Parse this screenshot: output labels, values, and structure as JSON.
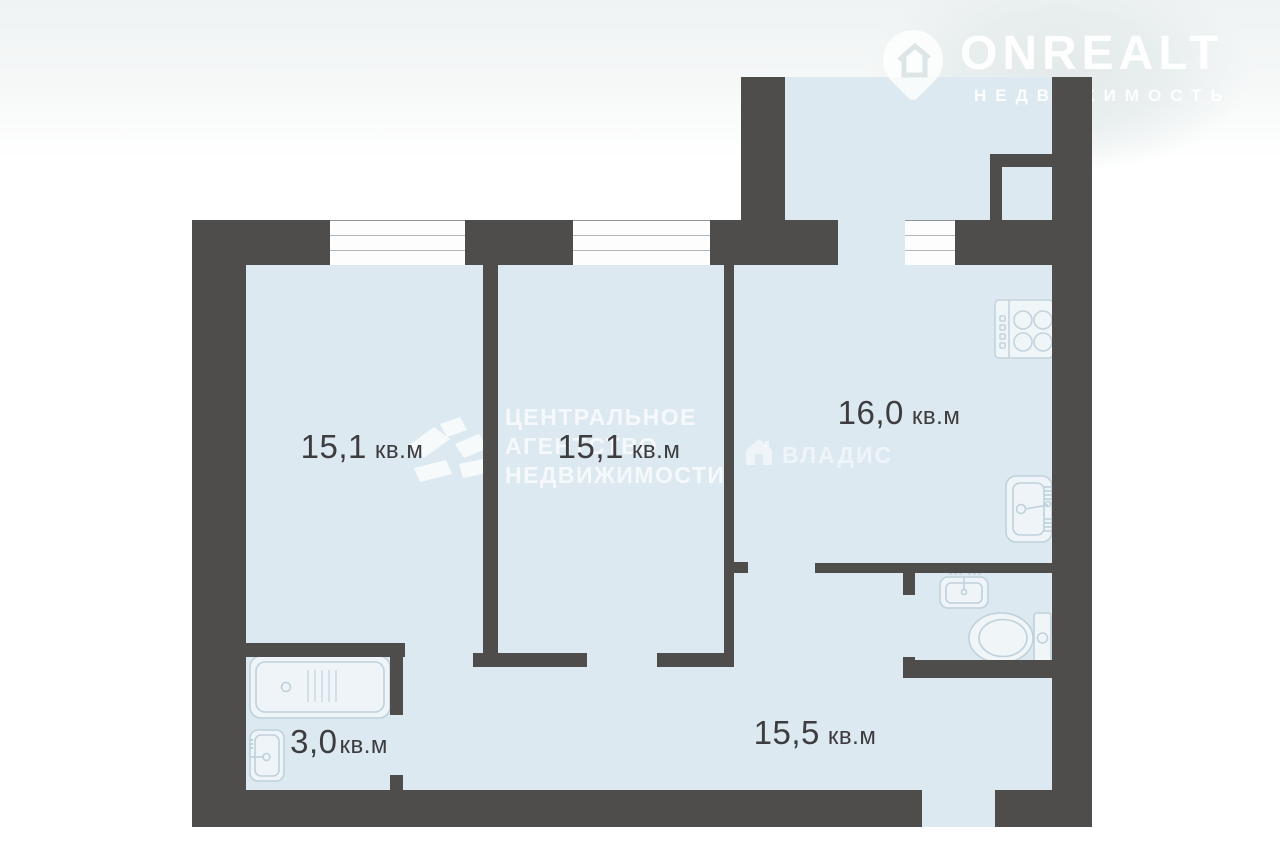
{
  "branding": {
    "logo": {
      "name": "ONREALT",
      "subtitle": "НЕДВИЖИМОСТЬ"
    },
    "watermark_agency": {
      "lines": [
        "ЦЕНТРАЛЬНОЕ",
        "АГЕНТСТВО",
        "НЕДВИЖИМОСТИ"
      ]
    },
    "watermark_vladis": {
      "name": "ВЛАДИС"
    }
  },
  "floorplan": {
    "type": "apartment-floor-plan",
    "rooms": [
      {
        "id": "room-left",
        "area": "15,1",
        "unit": "кв.м"
      },
      {
        "id": "room-middle",
        "area": "15,1",
        "unit": "кв.м"
      },
      {
        "id": "kitchen",
        "area": "16,0",
        "unit": "кв.м"
      },
      {
        "id": "bathroom",
        "area": "3,0",
        "unit": "кв.м"
      },
      {
        "id": "hallway",
        "area": "15,5",
        "unit": "кв.м"
      }
    ],
    "fixtures": [
      "stove",
      "kitchen-sink",
      "wc-sink",
      "toilet",
      "bathtub",
      "bathroom-sink"
    ],
    "colors": {
      "wall": "#4f4c4c",
      "floor": "#dde9f0",
      "fixture_stroke": "#bfd1db",
      "label_text": "#3d3d40"
    }
  }
}
